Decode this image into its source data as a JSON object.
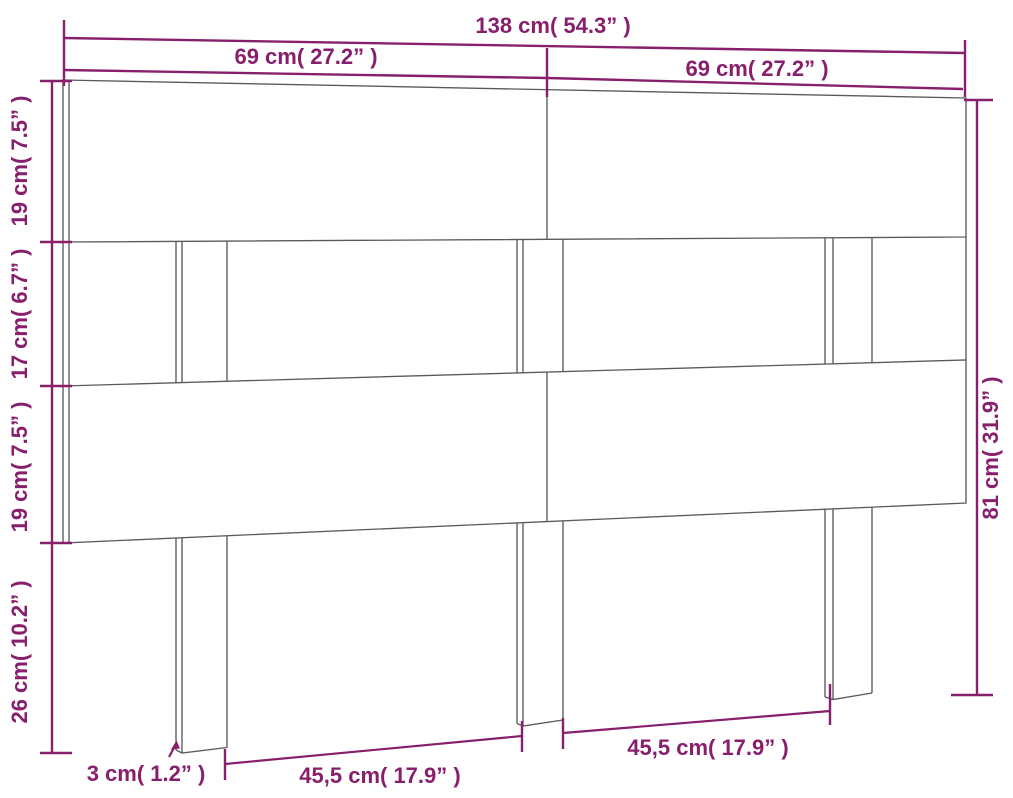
{
  "diagram": {
    "title": "headboard-dimension-drawing",
    "accent_color": "#881F6D",
    "line_color": "#595A5C",
    "dimensions": {
      "total_width": "138 cm( 54.3” )",
      "half_width_left": "69 cm( 27.2” )",
      "half_width_right": "69 cm( 27.2” )",
      "top_board_height": "19 cm( 7.5” )",
      "gap_height": "17 cm( 6.7” )",
      "middle_board_height": "19 cm( 7.5” )",
      "leg_height": "26 cm( 10.2” )",
      "total_height": "81 cm( 31.9” )",
      "board_thickness": "3 cm( 1.2” )",
      "leg_spacing_left": "45,5 cm( 17.9” )",
      "leg_spacing_right": "45,5 cm( 17.9” )"
    }
  }
}
